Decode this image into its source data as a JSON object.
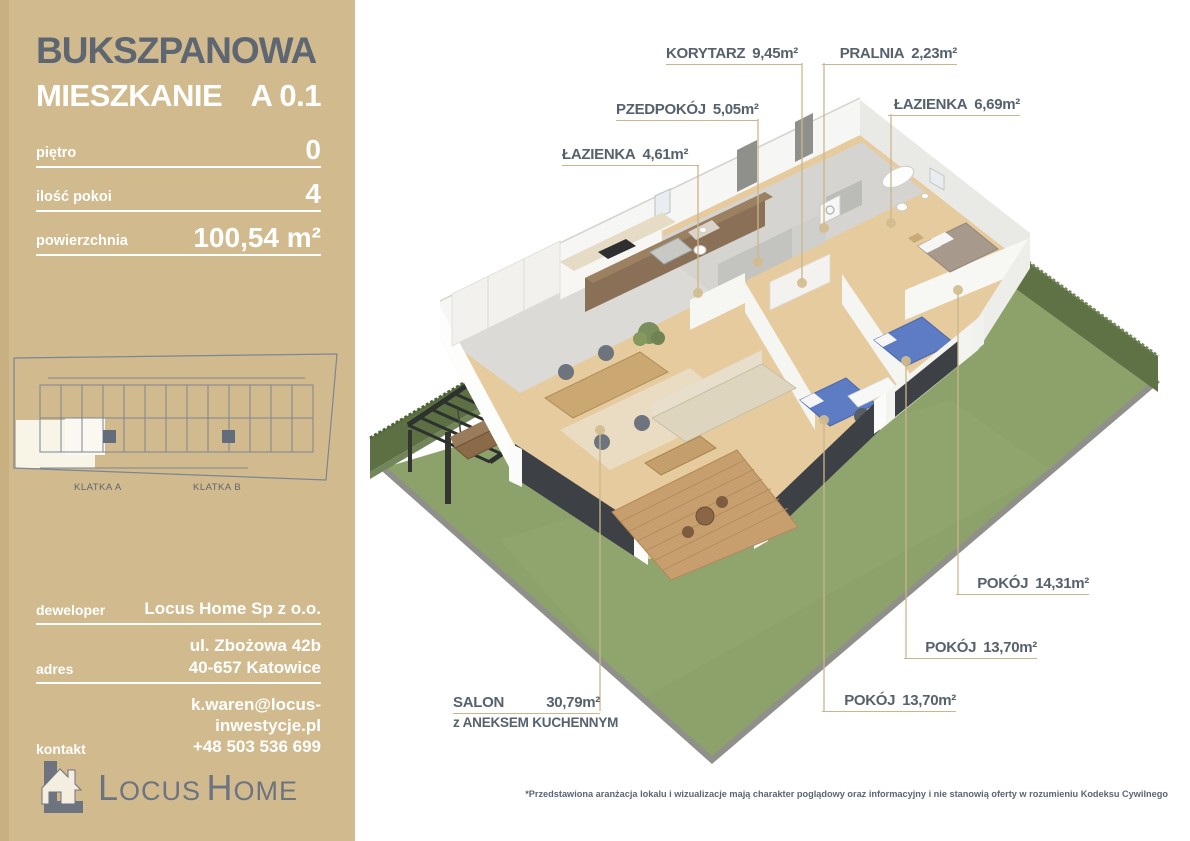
{
  "colors": {
    "sidebar_bg": "#d1ba8d",
    "accent_leader": "#cbb68b",
    "label_text": "#57616d",
    "title_text": "#5d6671",
    "grass": "#8da26b"
  },
  "sidebar": {
    "project_title": "BUKSZPANOWA",
    "unit_label": "MIESZKANIE",
    "unit_code": "A 0.1",
    "specs": [
      {
        "label": "piętro",
        "value": "0"
      },
      {
        "label": "ilość pokoi",
        "value": "4"
      },
      {
        "label": "powierzchnia",
        "value": "100,54 m²"
      }
    ],
    "site_plan": {
      "stairwell_a": "KLATKA A",
      "stairwell_b": "KLATKA B"
    },
    "developer": {
      "label": "deweloper",
      "value": "Locus Home Sp z o.o."
    },
    "address": {
      "label": "adres",
      "line1": "ul. Zbożowa 42b",
      "line2": "40-657 Katowice"
    },
    "contact": {
      "label": "kontakt",
      "email": "k.waren@locus-inwestycje.pl",
      "phone": "+48 503 536 699"
    },
    "logo": {
      "part1": "L",
      "part2": "OCUS",
      "part3": "H",
      "part4": "OME"
    }
  },
  "plan": {
    "rooms": [
      {
        "name": "KORYTARZ",
        "area": "9,45m²"
      },
      {
        "name": "PRALNIA",
        "area": "2,23m²"
      },
      {
        "name": "PZEDPOKÓJ",
        "area": "5,05m²"
      },
      {
        "name": "ŁAZIENKA",
        "area": "6,69m²"
      },
      {
        "name": "ŁAZIENKA",
        "area": "4,61m²"
      },
      {
        "name": "POKÓJ",
        "area": "14,31m²"
      },
      {
        "name": "POKÓJ",
        "area": "13,70m²"
      },
      {
        "name": "POKÓJ",
        "area": "13,70m²"
      }
    ],
    "salon": {
      "name": "SALON",
      "area": "30,79m²",
      "subtitle": "z ANEKSEM KUCHENNYM"
    },
    "disclaimer": "*Przedstawiona aranżacja lokalu i wizualizacje mają charakter poglądowy oraz informacyjny i nie stanowią oferty w rozumieniu Kodeksu Cywilnego"
  }
}
